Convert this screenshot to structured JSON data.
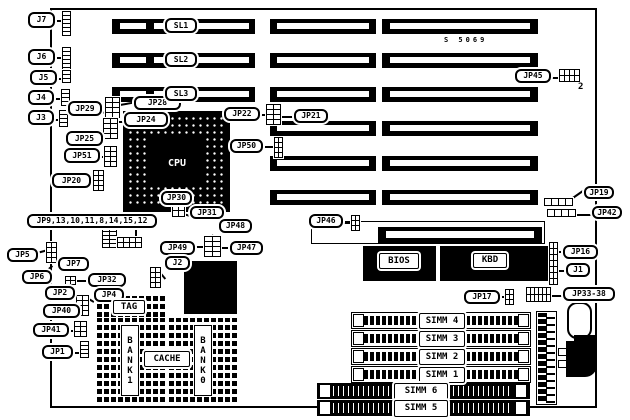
{
  "board": {
    "silkscreen": "S 5069",
    "pin_annotation": "2"
  },
  "labels": [
    {
      "id": "j7",
      "text": "J7"
    },
    {
      "id": "j6",
      "text": "J6"
    },
    {
      "id": "j5",
      "text": "J5"
    },
    {
      "id": "j4",
      "text": "J4"
    },
    {
      "id": "j3",
      "text": "J3"
    },
    {
      "id": "jp29",
      "text": "JP29"
    },
    {
      "id": "jp28",
      "text": "JP28"
    },
    {
      "id": "jp24",
      "text": "JP24"
    },
    {
      "id": "jp25",
      "text": "JP25"
    },
    {
      "id": "jp51",
      "text": "JP51"
    },
    {
      "id": "jp20",
      "text": "JP20"
    },
    {
      "id": "sl1",
      "text": "SL1"
    },
    {
      "id": "sl2",
      "text": "SL2"
    },
    {
      "id": "sl3",
      "text": "SL3"
    },
    {
      "id": "jp22",
      "text": "JP22"
    },
    {
      "id": "jp21",
      "text": "JP21"
    },
    {
      "id": "jp50",
      "text": "JP50"
    },
    {
      "id": "jp45",
      "text": "JP45"
    },
    {
      "id": "jp19",
      "text": "JP19"
    },
    {
      "id": "jp42",
      "text": "JP42"
    },
    {
      "id": "jp16",
      "text": "JP16"
    },
    {
      "id": "j1",
      "text": "J1"
    },
    {
      "id": "jp33_38",
      "text": "JP33-38"
    },
    {
      "id": "jp17",
      "text": "JP17"
    },
    {
      "id": "jp46",
      "text": "JP46"
    },
    {
      "id": "jp30",
      "text": "JP30"
    },
    {
      "id": "jp31",
      "text": "JP31"
    },
    {
      "id": "jp48",
      "text": "JP48"
    },
    {
      "id": "jp49",
      "text": "JP49"
    },
    {
      "id": "jp47",
      "text": "JP47"
    },
    {
      "id": "jp9",
      "text": "JP9,13,10,11,8,14,15,12"
    },
    {
      "id": "j2",
      "text": "J2"
    },
    {
      "id": "jp5",
      "text": "JP5"
    },
    {
      "id": "jp7",
      "text": "JP7"
    },
    {
      "id": "jp6",
      "text": "JP6"
    },
    {
      "id": "jp32",
      "text": "JP32"
    },
    {
      "id": "jp2",
      "text": "JP2"
    },
    {
      "id": "jp4",
      "text": "JP4"
    },
    {
      "id": "jp40",
      "text": "JP40"
    },
    {
      "id": "jp41",
      "text": "JP41"
    },
    {
      "id": "jp1",
      "text": "JP1"
    },
    {
      "id": "tag",
      "text": "TAG"
    },
    {
      "id": "cache",
      "text": "CACHE"
    },
    {
      "id": "bank1",
      "text": "BANK1"
    },
    {
      "id": "bank0",
      "text": "BANK0"
    },
    {
      "id": "cpu",
      "text": "CPU"
    },
    {
      "id": "bios",
      "text": "BIOS"
    },
    {
      "id": "kbd",
      "text": "KBD"
    },
    {
      "id": "simm4",
      "text": "SIMM 4"
    },
    {
      "id": "simm3",
      "text": "SIMM 3"
    },
    {
      "id": "simm2",
      "text": "SIMM 2"
    },
    {
      "id": "simm1",
      "text": "SIMM 1"
    },
    {
      "id": "simm6",
      "text": "SIMM 6"
    },
    {
      "id": "simm5",
      "text": "SIMM 5"
    }
  ]
}
